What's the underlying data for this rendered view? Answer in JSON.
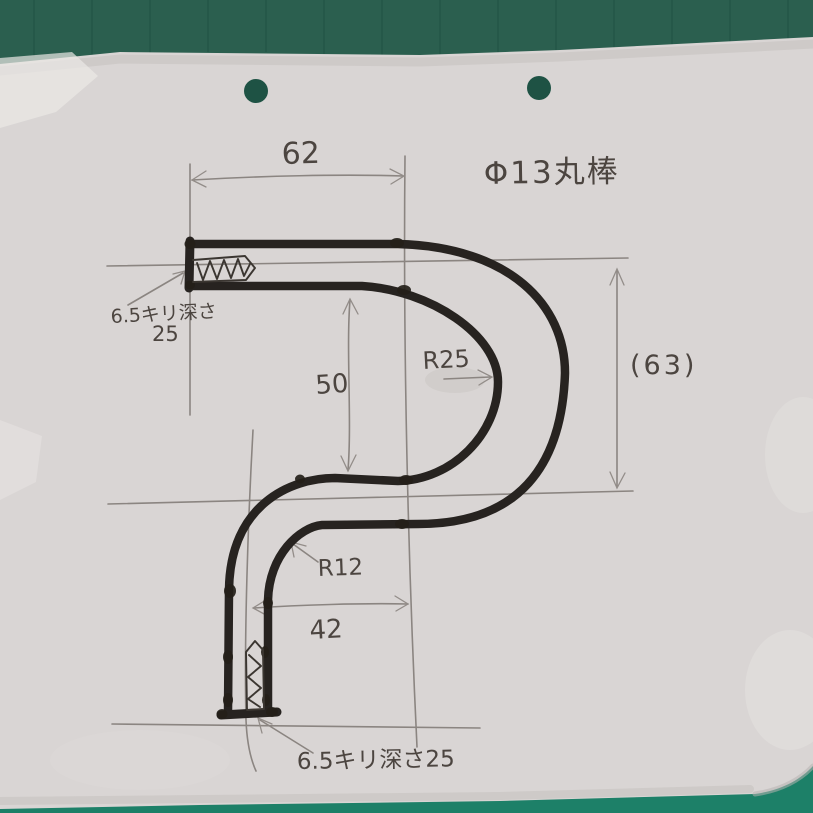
{
  "drawing": {
    "material_note": "Φ13丸棒",
    "dim_top_width": "62",
    "dim_overall_height": "(63)",
    "dim_mid_height": "50",
    "dim_bottom_width": "42",
    "radius_large": "R25",
    "radius_small": "R12",
    "hole_note_top_line1": "6.5キリ深さ",
    "hole_note_top_line2": "25",
    "hole_note_bottom": "6.5キリ深さ25"
  },
  "colors": {
    "mat_top": "#2b5f4f",
    "mat_bottom": "#1d8068",
    "paper": "#d9d5d4",
    "punch_hole": "#1e5244",
    "ink": "#272320",
    "pencil": "#8b8581",
    "label_ink": "#4c4540"
  }
}
